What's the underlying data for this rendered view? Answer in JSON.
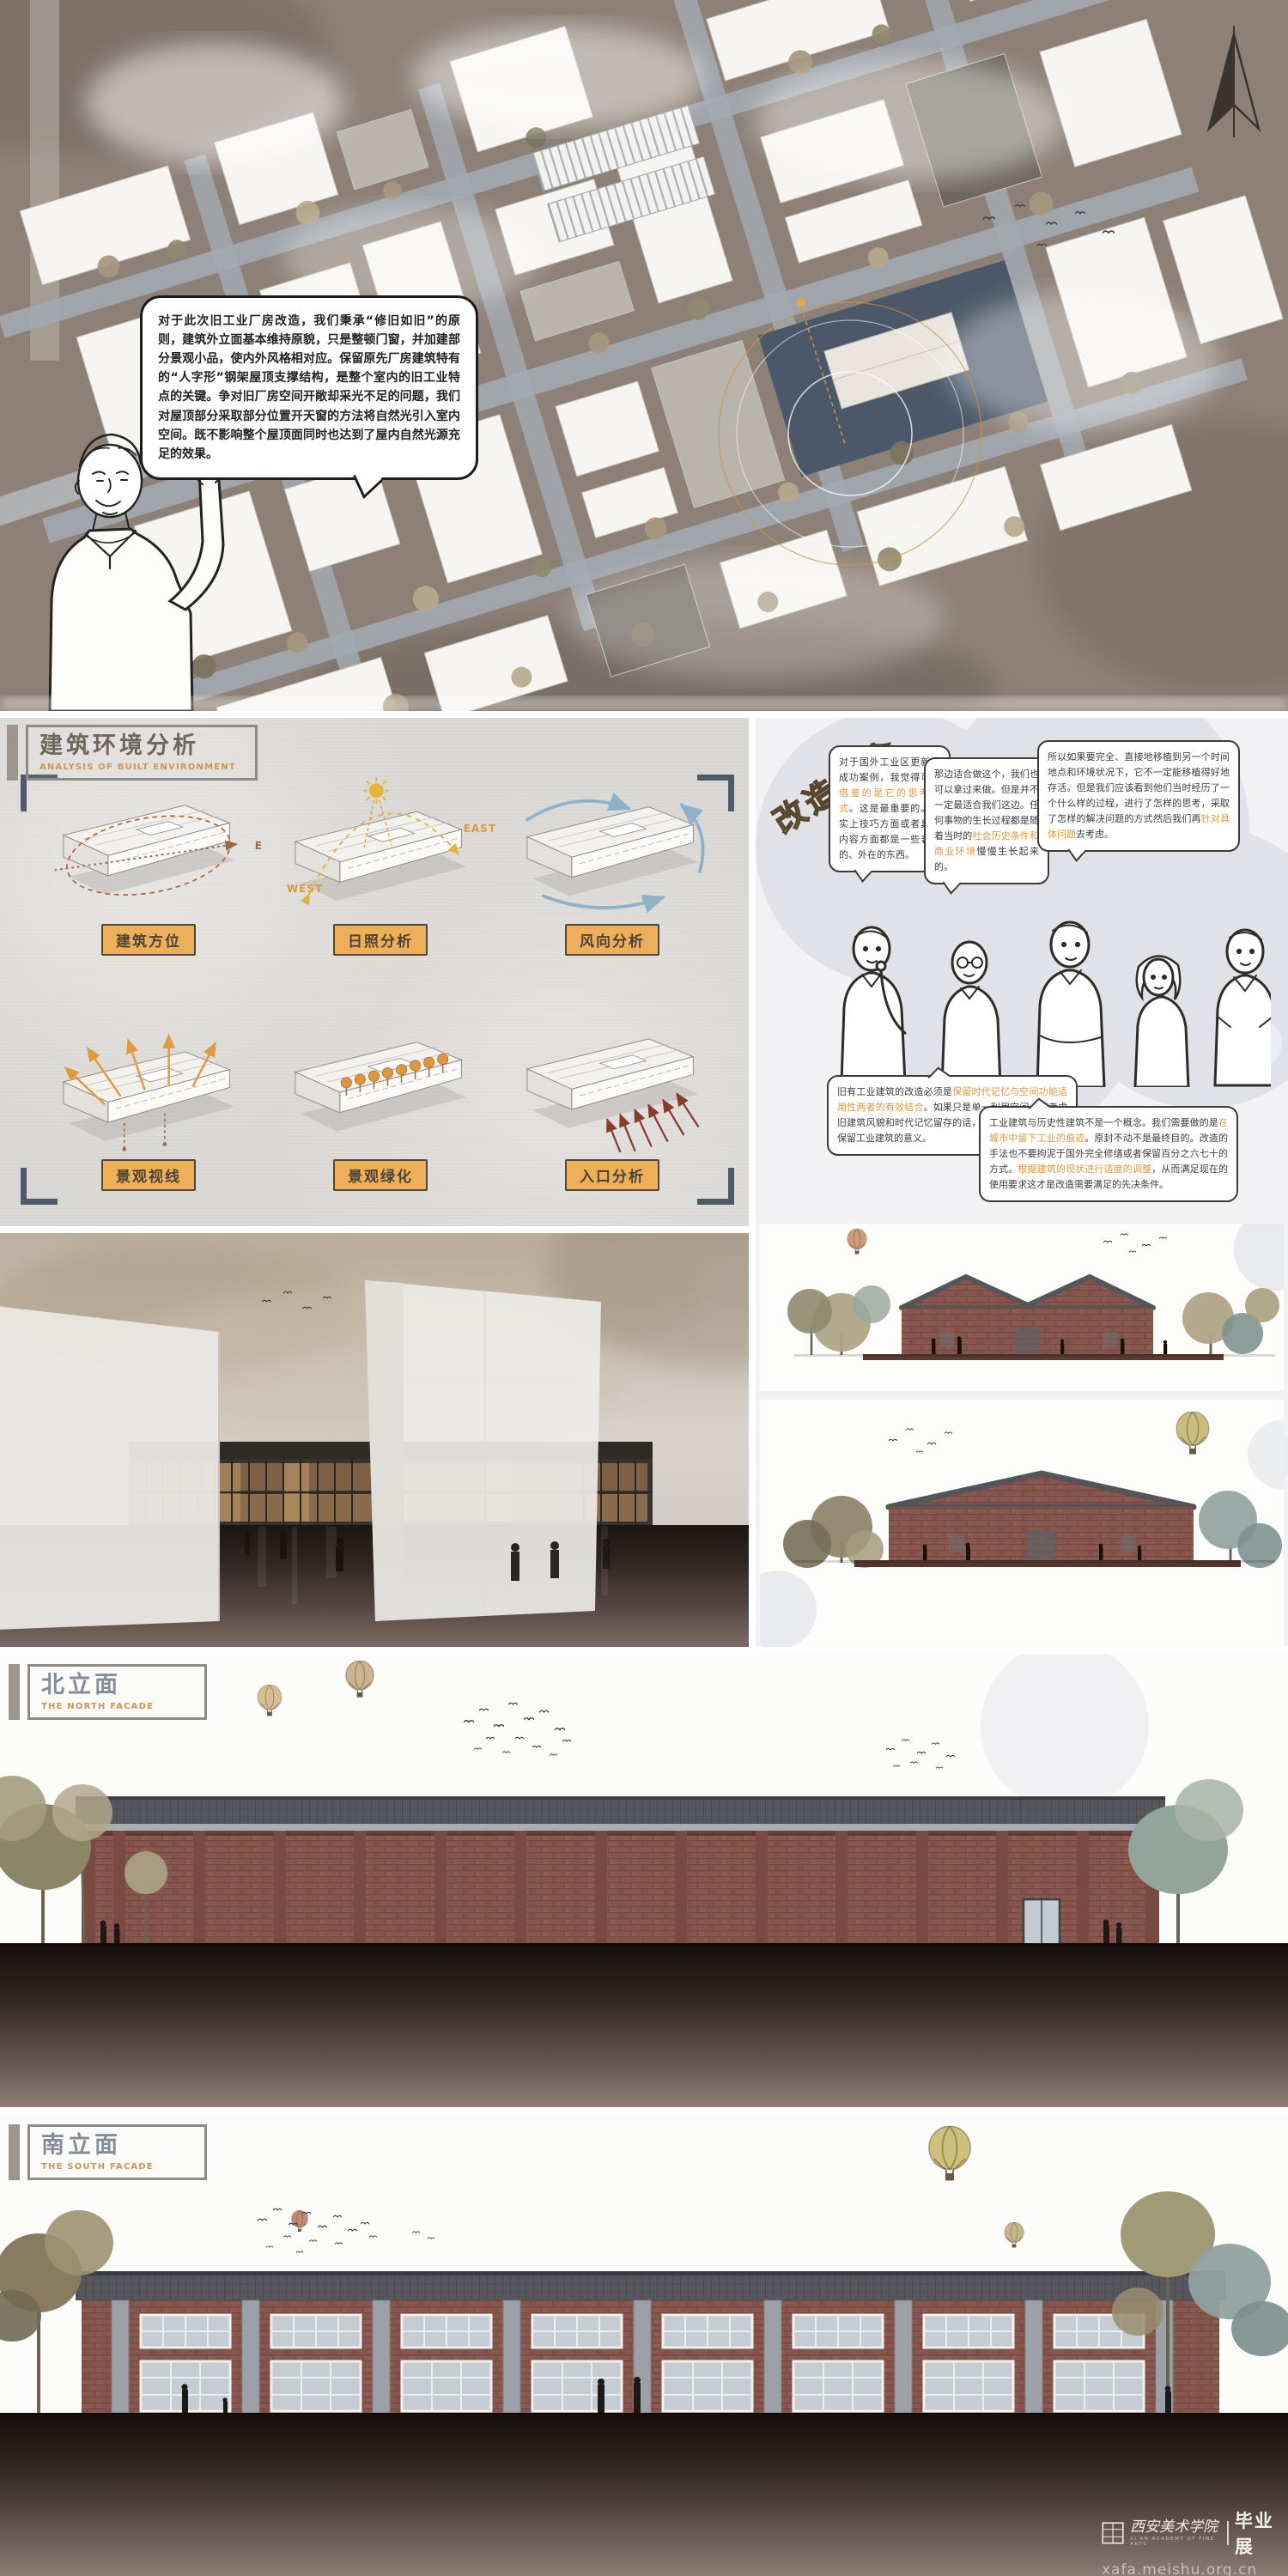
{
  "site_plan": {
    "bubble_text": "对于此次旧工业厂房改造，我们秉承“修旧如旧”的原则，建筑外立面基本维持原貌，只是整顿门窗，并加建部分景观小品，使内外风格相对应。保留原先厂房建筑特有的“人字形”钢架屋顶支撑结构，是整个室内的旧工业特点的关键。争对旧厂房空间开敞却采光不足的问题，我们对屋顶部分采取部分位置开天窗的方法将自然光引入室内空间。既不影响整个屋顶面同时也达到了屋内自然光源充足的效果。"
  },
  "analysis": {
    "title": "建筑环境分析",
    "subtitle": "ANALYSIS OF BUILT ENVIRONMENT",
    "east": "EAST",
    "west": "WEST",
    "dir_e": "E",
    "diagrams": [
      {
        "label": "建筑方位"
      },
      {
        "label": "日照分析"
      },
      {
        "label": "风向分析"
      },
      {
        "label": "景观视线"
      },
      {
        "label": "景观绿化"
      },
      {
        "label": "入口分析"
      }
    ]
  },
  "concept": {
    "title": "改造理念",
    "bubbles": [
      {
        "segments": [
          {
            "t": "对于国外工业区更新的成功案例，我觉得可以"
          },
          {
            "t": "借鉴的是它的思考方式",
            "hl": true
          },
          {
            "t": "。这是最重要的。事实上技巧方面或者具体内容方面都是一些表象的、外在的东西。"
          }
        ]
      },
      {
        "segments": [
          {
            "t": "那边适合做这个，我们也可以拿过来做。但是并不一定最适合我们这边。任何事物的生长过程都是随着当时的"
          },
          {
            "t": "社会历史条件和商业环境",
            "hl": true
          },
          {
            "t": "慢慢生长起来的。"
          }
        ]
      },
      {
        "segments": [
          {
            "t": "所以如果要完全、直接地移植到另一个时间地点和环境状况下，它不一定能移植得好地存活。但是我们应该看到他们当时经历了一个什么样的过程，进行了怎样的思考，采取了怎样的解决问题的方式然后我们再"
          },
          {
            "t": "针对具体问题",
            "hl": true
          },
          {
            "t": "去考虑。"
          }
        ]
      },
      {
        "segments": [
          {
            "t": "旧有工业建筑的改造必须是"
          },
          {
            "t": "保留时代记忆与空间功能适用性两者的有效结合",
            "hl": true
          },
          {
            "t": "。如果只是单一利用空间，不考虑旧建筑风貌和时代记忆留存的话，一定程度上也失去了保留工业建筑的意义。"
          }
        ]
      },
      {
        "segments": [
          {
            "t": "工业建筑与历史性建筑不是一个概念。我们需要做的是"
          },
          {
            "t": "在城市中留下工业的痕迹",
            "hl": true
          },
          {
            "t": "。原封不动不是最终目的。改造的手法也不要拘泥于国外完全修缮或者保留百分之六七十的方式。"
          },
          {
            "t": "根据建筑的现状进行适度的调整",
            "hl": true
          },
          {
            "t": "，从而满足现在的使用要求这才是改造需要满足的先决条件。"
          }
        ]
      }
    ]
  },
  "facades": {
    "north": {
      "title": "北立面",
      "subtitle": "THE NORTH FACADE"
    },
    "south": {
      "title": "南立面",
      "subtitle": "THE SOUTH FACADE"
    }
  },
  "footer": {
    "school": "西安美术学院",
    "school_en": "XI'AN ACADEMY OF FINE ARTS",
    "show": "毕业展",
    "url": "xafa.meishu.org.cn"
  },
  "colors": {
    "accent_orange": "#e2973a",
    "label_bg": "#efae58",
    "brick": "#8a574e",
    "slate_bracket": "#4e5a68",
    "roof_gray": "#56575c"
  }
}
